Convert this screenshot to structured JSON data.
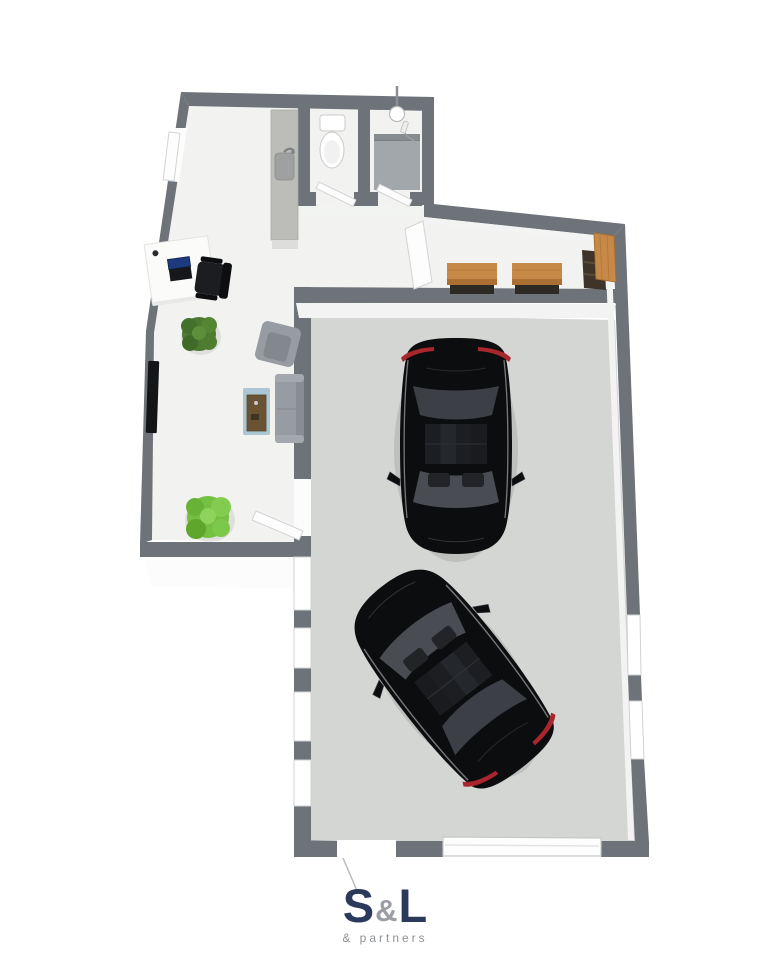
{
  "logo": {
    "letter_s": "S",
    "ampersand": "&",
    "letter_l": "L",
    "tagline": "& partners",
    "navy": "#2b3a5a",
    "gray": "#9b9ea4",
    "tagline_color": "#8f9297"
  },
  "floorplan": {
    "view": "3d-top-down-render",
    "colors": {
      "wall": "#6d7378",
      "office_floor": "#f2f3f1",
      "garage_floor": "#d4d6d4",
      "inner_face": "#f2f3f2",
      "counter": "#bcbdb9",
      "shower_tile": "#a2a7ab",
      "wood": "#c78947",
      "wood_dark": "#a96f33",
      "shelf_brown": "#3f342a",
      "plant_dark": "#4c7a31",
      "plant_bright": "#74c040",
      "sofa_gray": "#979ba2",
      "rug_blue": "#abc7d3",
      "table_wood": "#6a5335",
      "car_black": "#0c0d0f",
      "car_glass": "#494d53",
      "tail_light_red": "#a8262c",
      "door_white": "#fdfdfd"
    },
    "rooms": [
      {
        "id": "office-lounge"
      },
      {
        "id": "wc"
      },
      {
        "id": "shower-room"
      },
      {
        "id": "hallway"
      },
      {
        "id": "workbench-nook"
      },
      {
        "id": "garage"
      }
    ],
    "furniture": [
      "entry-door",
      "desk",
      "laptop",
      "office-chair",
      "potted-plant-dark",
      "potted-plant-bright",
      "tv",
      "armchair",
      "sofa",
      "coffee-table",
      "rug",
      "sink-counter",
      "toilet",
      "shower",
      "wc-door",
      "shower-door",
      "workshop-door",
      "office-garage-door",
      "workbench",
      "workbench",
      "wall-cabinet",
      "shelf-unit",
      "black-car",
      "black-car",
      "garage-door",
      "windows"
    ]
  }
}
